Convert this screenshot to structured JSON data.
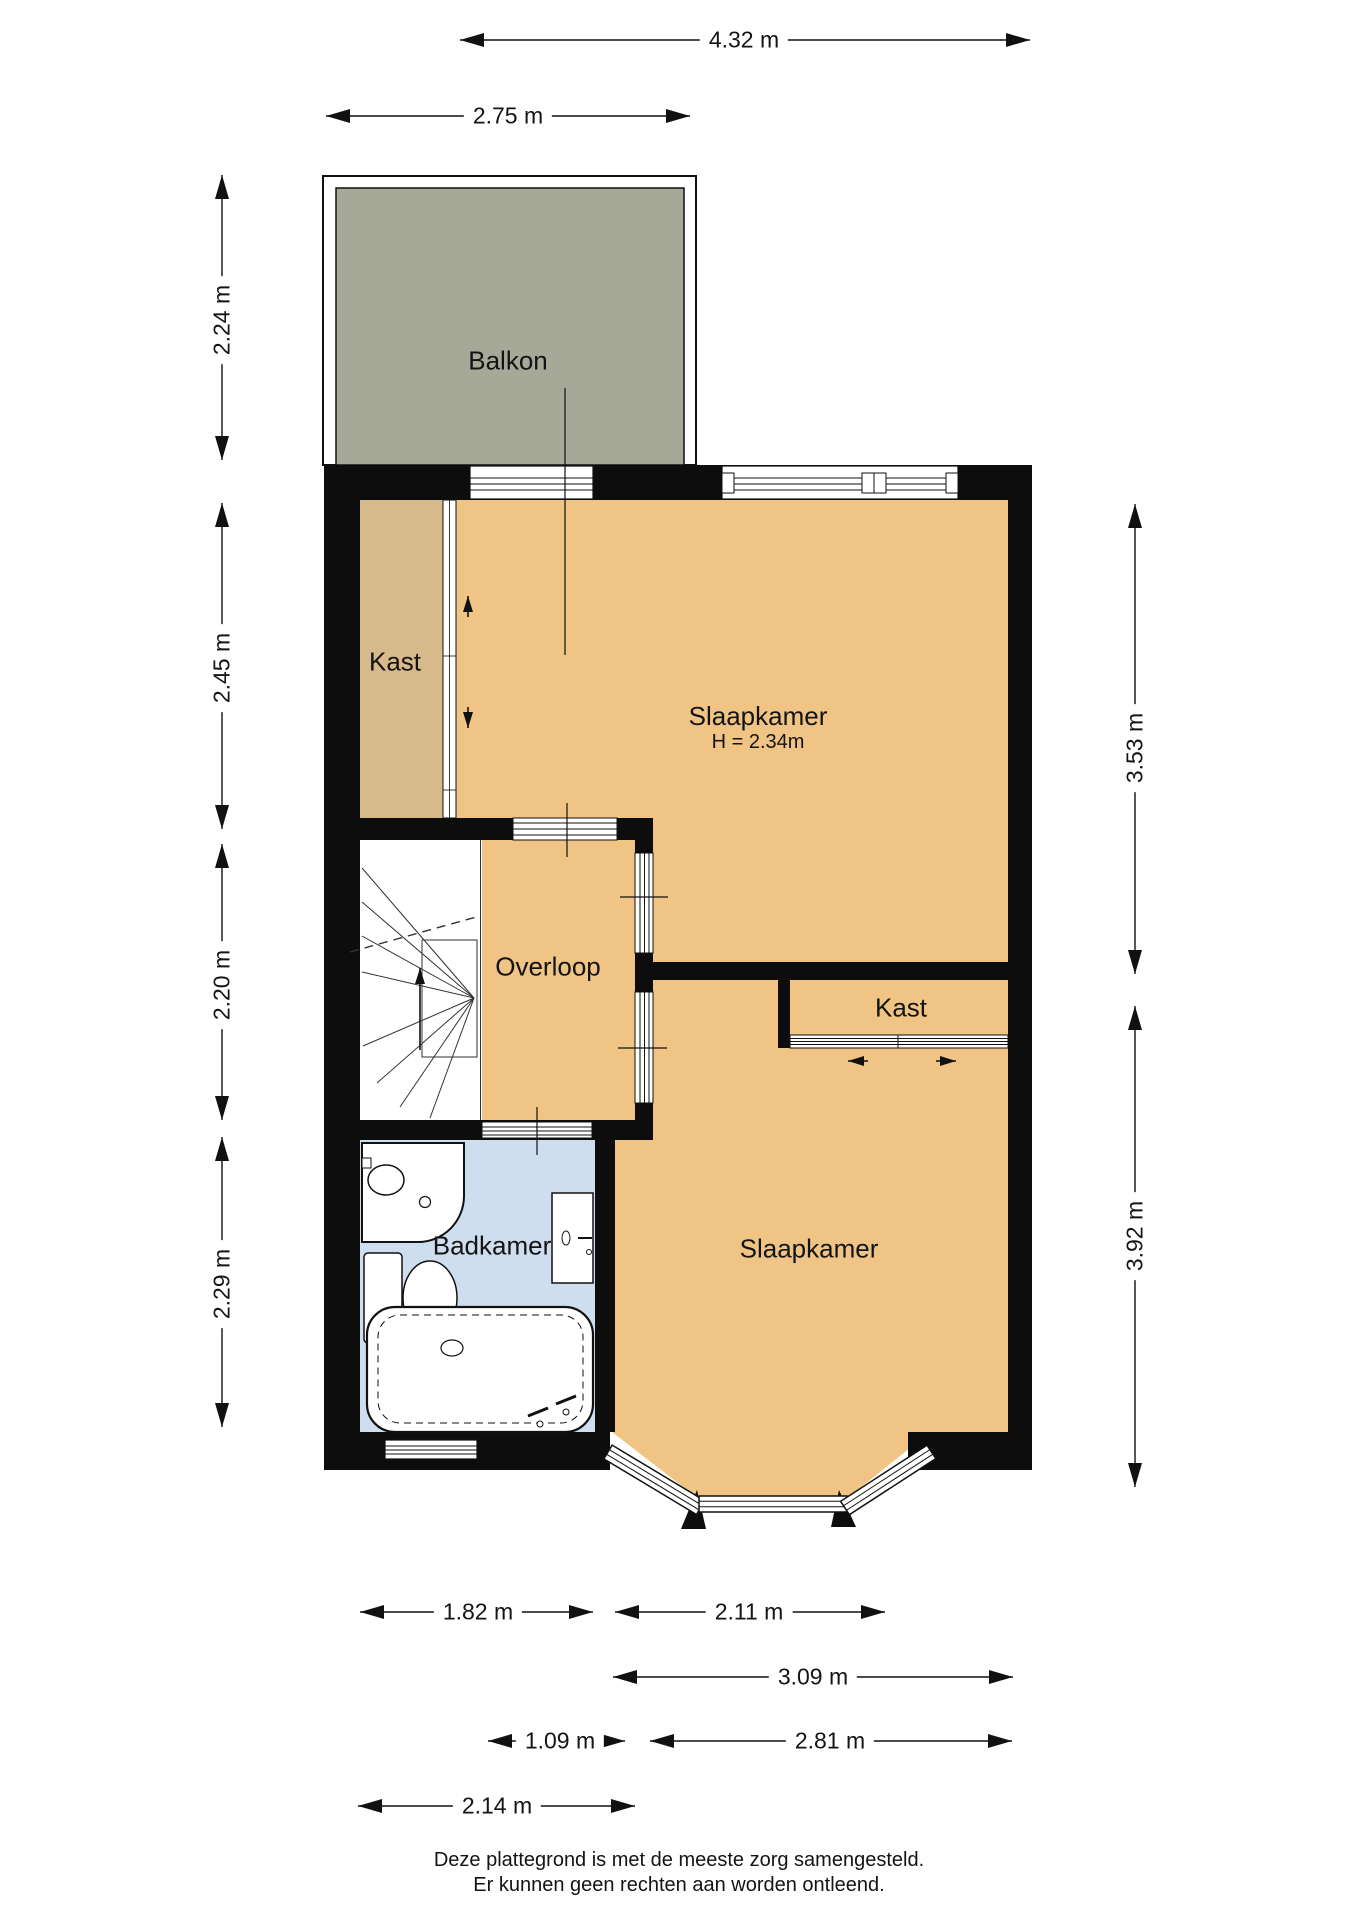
{
  "rooms": {
    "balkon": {
      "label": "Balkon"
    },
    "kast_upper": {
      "label": "Kast"
    },
    "slaapkamer_top": {
      "label": "Slaapkamer",
      "height_note": "H = 2.34m"
    },
    "overloop": {
      "label": "Overloop"
    },
    "kast_right": {
      "label": "Kast"
    },
    "badkamer": {
      "label": "Badkamer"
    },
    "slaapkamer_bottom": {
      "label": "Slaapkamer"
    }
  },
  "dimensions": {
    "top_total_width": "4.32 m",
    "balcony_width": "2.75 m",
    "balcony_depth": "2.24 m",
    "kast_side_height": "2.45 m",
    "overloop_side_height": "2.20 m",
    "badkamer_side_height": "2.29 m",
    "slaapkamer_top_height": "3.53 m",
    "slaapkamer_bot_height": "3.92 m",
    "badkamer_width": "1.82 m",
    "bay_width": "2.11 m",
    "slaapkamer_bot_width": "3.09 m",
    "overloop_width": "1.09 m",
    "slaapkamer_inner_width": "2.81 m",
    "stair_hall_width": "2.14 m"
  },
  "footer": {
    "line1": "Deze plattegrond is met de meeste zorg samengesteld.",
    "line2": "Er kunnen geen rechten aan worden ontleend."
  },
  "colors": {
    "room_orange": "#f0c484",
    "closet_tan": "#d7ba8c",
    "bathroom_blue": "#cfdeee",
    "balcony_gray": "#a7a998",
    "wall_black": "#0d0d0d"
  }
}
